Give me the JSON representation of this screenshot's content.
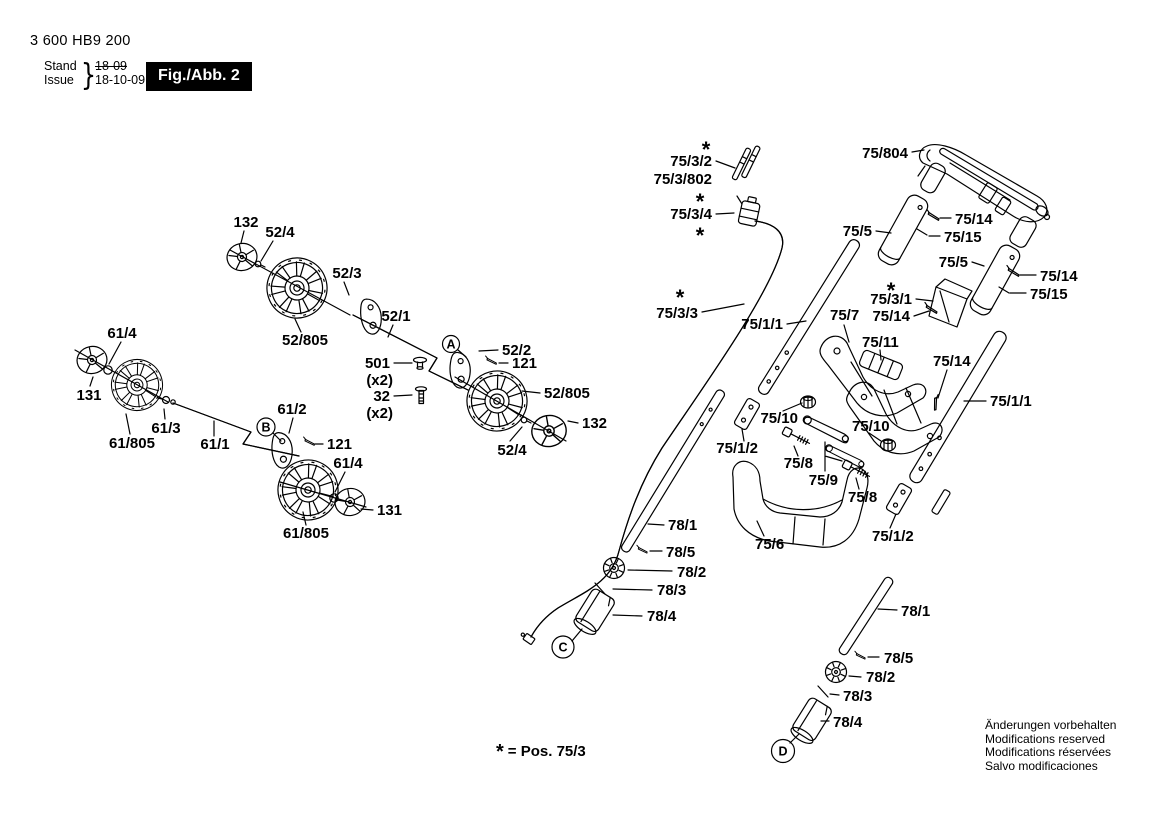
{
  "header": {
    "part_number": "3 600 HB9 200",
    "stand_label": "Stand",
    "issue_label": "Issue",
    "brace": "}",
    "old_date": "18-09",
    "new_date": "18-10-09",
    "figure_label": "Fig./Abb. 2"
  },
  "footer": {
    "footnote_star": "*",
    "footnote_text": "= Pos. 75/3",
    "notice_lines": [
      "Änderungen vorbehalten",
      "Modifications reserved",
      "Modifications réservées",
      "Salvo modificaciones"
    ]
  },
  "colors": {
    "ink": "#000000",
    "paper": "#ffffff",
    "figure_box_bg": "#000000",
    "figure_box_text": "#ffffff"
  },
  "callouts": [
    {
      "letter": "A",
      "x": 451,
      "y": 344,
      "r": 8.5
    },
    {
      "letter": "B",
      "x": 266,
      "y": 427,
      "r": 9
    },
    {
      "letter": "C",
      "x": 563,
      "y": 647,
      "r": 11
    },
    {
      "letter": "D",
      "x": 783,
      "y": 751,
      "r": 11.5
    }
  ],
  "part_labels": [
    {
      "t": "*",
      "x": 706,
      "y": 157,
      "a": "m",
      "s": true
    },
    {
      "t": "75/3/2",
      "x": 712,
      "y": 166,
      "a": "e"
    },
    {
      "t": "75/3/802",
      "x": 712,
      "y": 184,
      "a": "e"
    },
    {
      "t": "*",
      "x": 700,
      "y": 209,
      "a": "m",
      "s": true
    },
    {
      "t": "75/3/4",
      "x": 712,
      "y": 219,
      "a": "e"
    },
    {
      "t": "*",
      "x": 700,
      "y": 243,
      "a": "m",
      "s": true
    },
    {
      "t": "75/804",
      "x": 908,
      "y": 158,
      "a": "e"
    },
    {
      "t": "75/5",
      "x": 872,
      "y": 236,
      "a": "e"
    },
    {
      "t": "75/14",
      "x": 955,
      "y": 224,
      "a": "s"
    },
    {
      "t": "75/15",
      "x": 944,
      "y": 242,
      "a": "s"
    },
    {
      "t": "75/5",
      "x": 968,
      "y": 267,
      "a": "e"
    },
    {
      "t": "75/14",
      "x": 1040,
      "y": 281,
      "a": "s"
    },
    {
      "t": "75/15",
      "x": 1030,
      "y": 299,
      "a": "s"
    },
    {
      "t": "*",
      "x": 891,
      "y": 298,
      "a": "m",
      "s": true
    },
    {
      "t": "75/3/1",
      "x": 912,
      "y": 304,
      "a": "e"
    },
    {
      "t": "75/14",
      "x": 910,
      "y": 321,
      "a": "e"
    },
    {
      "t": "*",
      "x": 680,
      "y": 305,
      "a": "m",
      "s": true
    },
    {
      "t": "75/3/3",
      "x": 698,
      "y": 318,
      "a": "e"
    },
    {
      "t": "75/1/1",
      "x": 783,
      "y": 329,
      "a": "e"
    },
    {
      "t": "75/7",
      "x": 830,
      "y": 320,
      "a": "s"
    },
    {
      "t": "75/11",
      "x": 862,
      "y": 347,
      "a": "s"
    },
    {
      "t": "75/14",
      "x": 933,
      "y": 366,
      "a": "s"
    },
    {
      "t": "75/1/1",
      "x": 990,
      "y": 406,
      "a": "s"
    },
    {
      "t": "75/10",
      "x": 798,
      "y": 423,
      "a": "e"
    },
    {
      "t": "75/10",
      "x": 852,
      "y": 431,
      "a": "s"
    },
    {
      "t": "75/1/2",
      "x": 758,
      "y": 453,
      "a": "e"
    },
    {
      "t": "75/8",
      "x": 813,
      "y": 468,
      "a": "e"
    },
    {
      "t": "75/9",
      "x": 838,
      "y": 485,
      "a": "e"
    },
    {
      "t": "75/8",
      "x": 848,
      "y": 502,
      "a": "s"
    },
    {
      "t": "75/1/2",
      "x": 872,
      "y": 541,
      "a": "s"
    },
    {
      "t": "75/6",
      "x": 755,
      "y": 549,
      "a": "s"
    },
    {
      "t": "78/1",
      "x": 668,
      "y": 530,
      "a": "s"
    },
    {
      "t": "78/5",
      "x": 666,
      "y": 557,
      "a": "s"
    },
    {
      "t": "78/2",
      "x": 677,
      "y": 577,
      "a": "s"
    },
    {
      "t": "78/3",
      "x": 657,
      "y": 595,
      "a": "s"
    },
    {
      "t": "78/4",
      "x": 647,
      "y": 621,
      "a": "s"
    },
    {
      "t": "78/1",
      "x": 901,
      "y": 616,
      "a": "s"
    },
    {
      "t": "78/5",
      "x": 884,
      "y": 663,
      "a": "s"
    },
    {
      "t": "78/2",
      "x": 866,
      "y": 682,
      "a": "s"
    },
    {
      "t": "78/3",
      "x": 843,
      "y": 701,
      "a": "s"
    },
    {
      "t": "78/4",
      "x": 833,
      "y": 727,
      "a": "s"
    },
    {
      "t": "132",
      "x": 246,
      "y": 227,
      "a": "m"
    },
    {
      "t": "52/4",
      "x": 280,
      "y": 237,
      "a": "m"
    },
    {
      "t": "52/3",
      "x": 347,
      "y": 278,
      "a": "m"
    },
    {
      "t": "52/805",
      "x": 305,
      "y": 345,
      "a": "m"
    },
    {
      "t": "52/1",
      "x": 396,
      "y": 321,
      "a": "m"
    },
    {
      "t": "501",
      "x": 390,
      "y": 368,
      "a": "e"
    },
    {
      "t": "(x2)",
      "x": 393,
      "y": 385,
      "a": "e"
    },
    {
      "t": "32",
      "x": 390,
      "y": 401,
      "a": "e"
    },
    {
      "t": "(x2)",
      "x": 393,
      "y": 418,
      "a": "e"
    },
    {
      "t": "52/2",
      "x": 502,
      "y": 355,
      "a": "s"
    },
    {
      "t": "121",
      "x": 512,
      "y": 368,
      "a": "s"
    },
    {
      "t": "52/805",
      "x": 544,
      "y": 398,
      "a": "s"
    },
    {
      "t": "132",
      "x": 582,
      "y": 428,
      "a": "s"
    },
    {
      "t": "52/4",
      "x": 512,
      "y": 455,
      "a": "m"
    },
    {
      "t": "61/4",
      "x": 122,
      "y": 338,
      "a": "m"
    },
    {
      "t": "131",
      "x": 89,
      "y": 400,
      "a": "m"
    },
    {
      "t": "61/3",
      "x": 166,
      "y": 433,
      "a": "m"
    },
    {
      "t": "61/805",
      "x": 132,
      "y": 448,
      "a": "m"
    },
    {
      "t": "61/1",
      "x": 215,
      "y": 449,
      "a": "m"
    },
    {
      "t": "61/2",
      "x": 292,
      "y": 414,
      "a": "m"
    },
    {
      "t": "121",
      "x": 327,
      "y": 449,
      "a": "s"
    },
    {
      "t": "61/4",
      "x": 348,
      "y": 468,
      "a": "m"
    },
    {
      "t": "131",
      "x": 377,
      "y": 515,
      "a": "s"
    },
    {
      "t": "61/805",
      "x": 306,
      "y": 538,
      "a": "m"
    }
  ]
}
